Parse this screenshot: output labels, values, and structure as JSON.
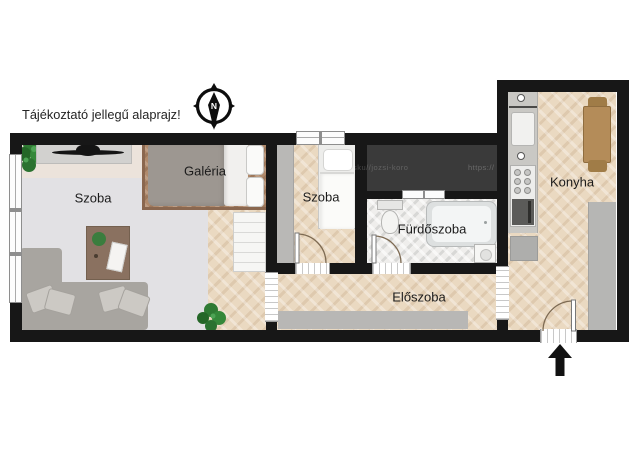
{
  "title": "Tájékoztató jellegű alaprajz!",
  "compass": {
    "north_label": "N"
  },
  "rooms": {
    "living": {
      "label": "Szoba"
    },
    "galeria": {
      "label": "Galéria"
    },
    "bedroom": {
      "label": "Szoba"
    },
    "bathroom": {
      "label": "Fürdőszoba"
    },
    "hallway": {
      "label": "Előszoba"
    },
    "kitchen": {
      "label": "Konyha"
    }
  },
  "watermarks": {
    "left": "w.ocsku//jozsi-koro",
    "right": "https://"
  },
  "icons": {
    "compass": "compass-rose-north",
    "entrance_arrow": "entrance-direction-arrow",
    "plants": "potted-plant"
  },
  "colors": {
    "wall": "#171717",
    "wood_floor": "#ead9c1",
    "galeria_platform": "#b08a6c",
    "dark_shaft": "#3a3a3a",
    "bathroom_tile": "#efeeec",
    "rug": "#e2e1e4",
    "furniture_gray": "#b6b6b4"
  }
}
